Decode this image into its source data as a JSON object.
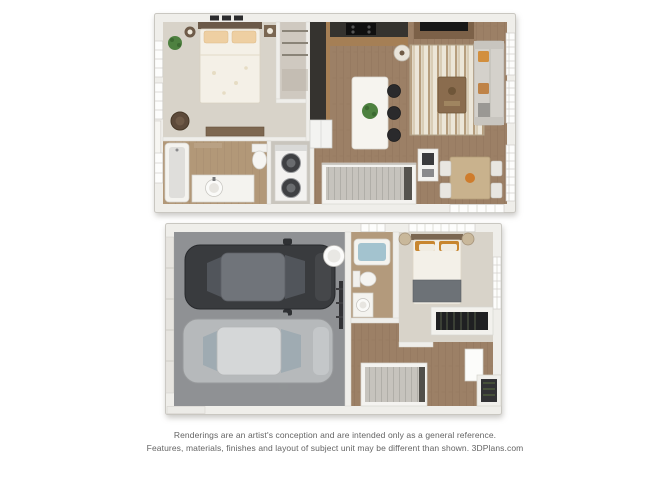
{
  "page": {
    "background_color": "#ffffff"
  },
  "floor_plans": {
    "count": 2,
    "upper_floor": {
      "rooms_visible": [
        "bedroom",
        "closet",
        "bathroom",
        "laundry",
        "kitchen",
        "kitchen-island",
        "living-room",
        "dining-area",
        "stairs"
      ]
    },
    "lower_floor": {
      "rooms_visible": [
        "two-car-garage",
        "water-heater",
        "bathroom",
        "bedroom",
        "closet",
        "entry-hall",
        "stairs"
      ]
    },
    "palette": {
      "wall": "#efeeea",
      "carpet": "#d8d3c9",
      "wood_floor": "#9c8066",
      "bath_floor": "#b29878",
      "closet_floor": "#cfc9c0",
      "garage_floor": "#8f9194",
      "car_dark": "#393b3e",
      "car_dark_roof": "#70747a",
      "car_silver": "#b6b9bb",
      "car_silver_roof": "#d5d7d8",
      "sofa": "#d4d1cb",
      "accent_orange": "#d28f3e",
      "pillow_orange": "#c8862f",
      "plant_green": "#4e8140",
      "tub_water": "#a3c3cf",
      "counter_dark": "#35332f",
      "cabinet_wood": "#a57f55",
      "table_tan": "#c9b28d",
      "stair_tread": "#c6c3bd"
    }
  },
  "disclaimer": {
    "line1": "Renderings are an artist's conception and are intended only as a general reference.",
    "line2": "Features, materials, finishes and layout of subject unit may be different than shown. 3DPlans.com",
    "text_color": "#646464"
  }
}
